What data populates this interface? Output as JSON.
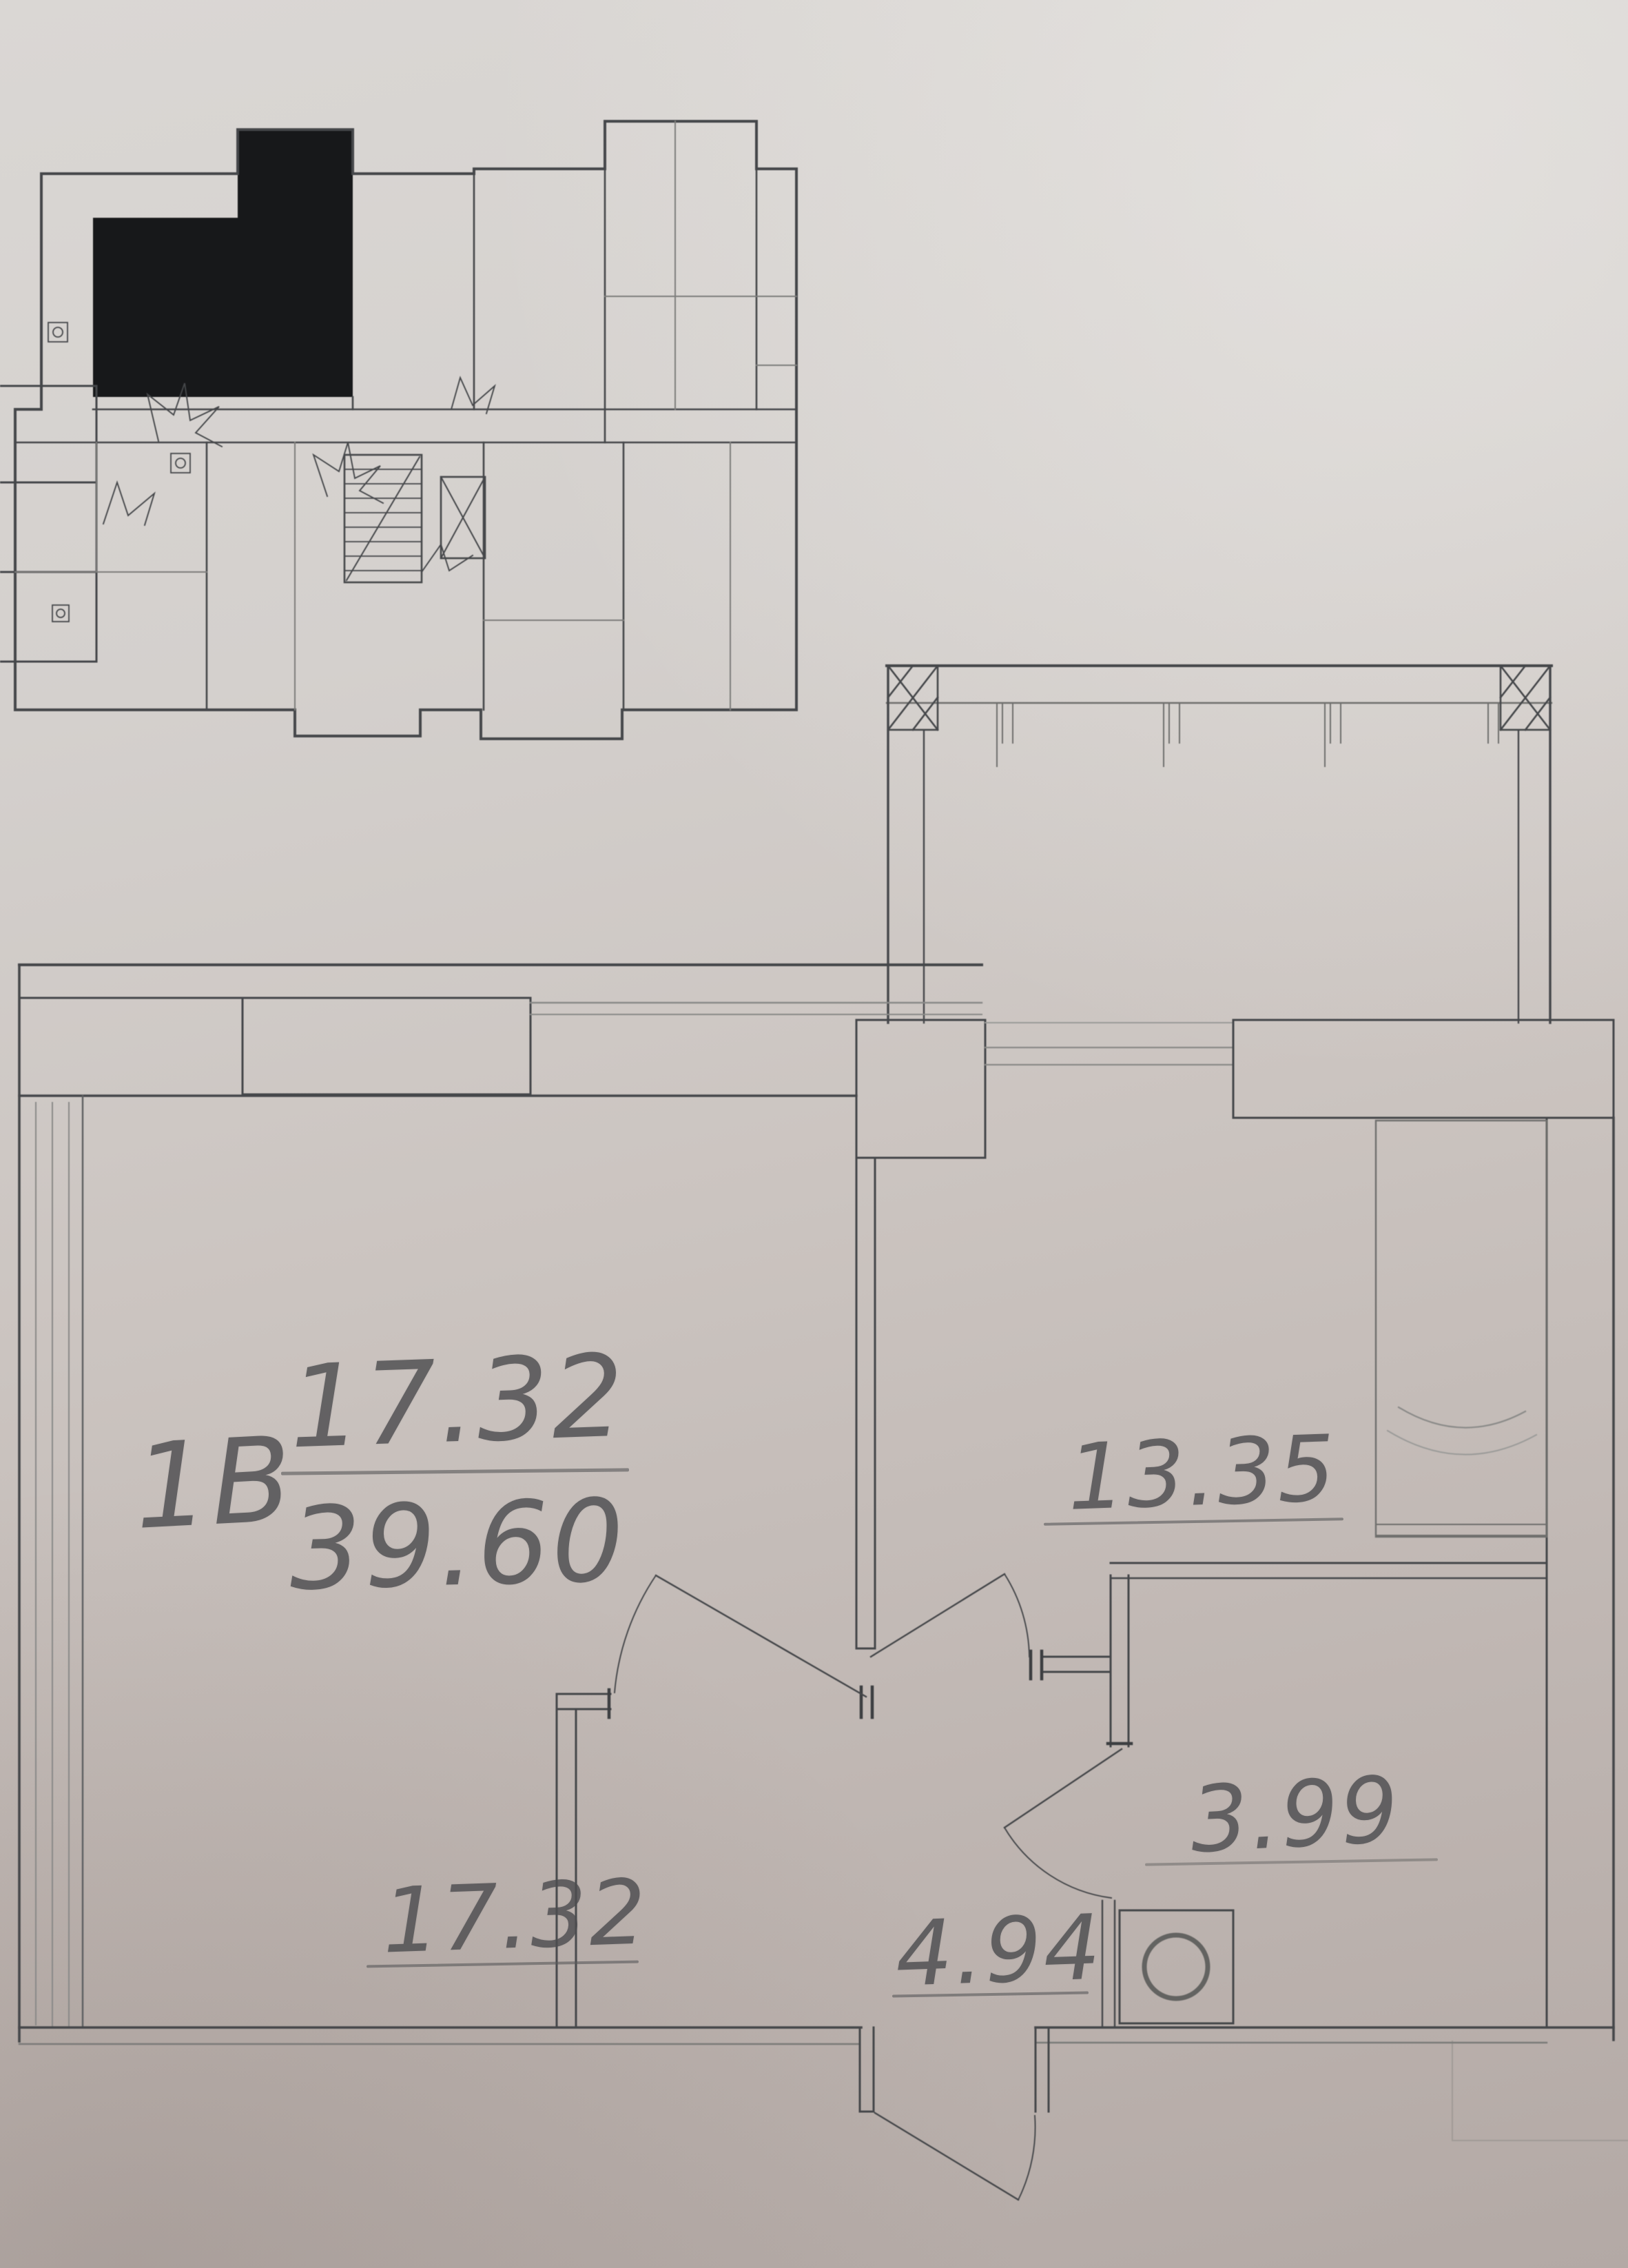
{
  "sheet": {
    "description": "Photographed apartment floor plan drawing",
    "colors": {
      "paper_top": "#dad7d4",
      "paper_bottom": "#b3a9a5",
      "line_dark": "#45474a",
      "line_soft": "#8a8a88",
      "highlighted_unit_fill": "#17181a",
      "pencil_text": "#4d4d50"
    }
  },
  "overview_inset": {
    "role": "building floor locator plan",
    "highlighted_unit": "selected apartment filled black",
    "icons": [
      "stairs-icon",
      "elevator-icon",
      "door-swing-icon",
      "fixture-icon"
    ]
  },
  "plan": {
    "unit_type_label": "1В",
    "area_fraction": {
      "numerator": "17.32",
      "denominator": "39.60"
    },
    "room_areas": {
      "living_room": "17.32",
      "kitchen": "13.35",
      "bathroom": "3.99",
      "hallway": "4.94"
    },
    "fixtures": {
      "washing_machine": "washing-machine-icon",
      "kitchen_counter_sink": "kitchen-sink-icon",
      "balcony_railing": "balcony-railing"
    }
  }
}
